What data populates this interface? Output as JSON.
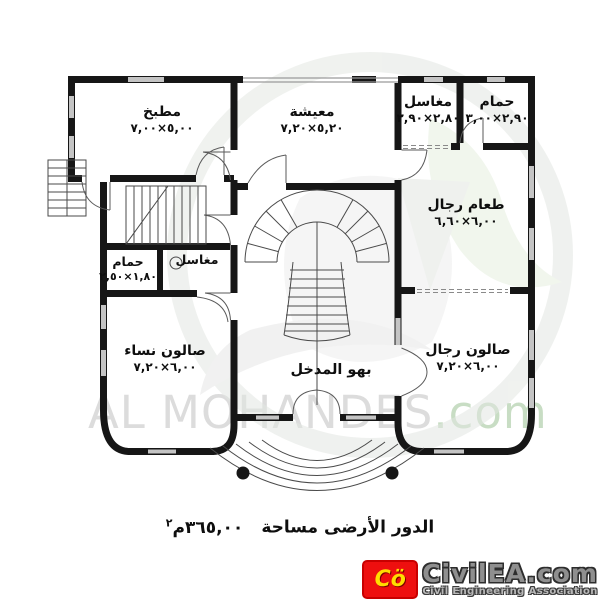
{
  "plan": {
    "rooms": [
      {
        "id": "kitchen",
        "name": "مطبخ",
        "dims": "٥,٠٠×٧,٠٠"
      },
      {
        "id": "living",
        "name": "معيشة",
        "dims": "٥,٢٠×٧,٢٠"
      },
      {
        "id": "sinks_top",
        "name": "مغاسل",
        "dims": "٢,٨٠×٢,٩٠"
      },
      {
        "id": "bath_top",
        "name": "حمام",
        "dims": "٢,٩٠×٣,٠٠"
      },
      {
        "id": "dining_men",
        "name": "طعام رجال",
        "dims": "٦,٠٠×٦,٦٠"
      },
      {
        "id": "bath_small",
        "name": "حمام",
        "dims": "١,٨٠×٢,٥٠"
      },
      {
        "id": "sinks_small",
        "name": "مغاسل",
        "dims": ""
      },
      {
        "id": "salon_women",
        "name": "صالون نساء",
        "dims": "٦,٠٠×٧,٢٠"
      },
      {
        "id": "salon_men",
        "name": "صالون رجال",
        "dims": "٦,٠٠×٧,٢٠"
      },
      {
        "id": "entry_hall",
        "name": "بهو المدخل",
        "dims": ""
      }
    ],
    "caption": {
      "label": "الدور الأرضى مساحة",
      "value": "٣٦٥,٠٠",
      "unit": "م",
      "sup": "٢"
    }
  },
  "watermark": {
    "name": "AL MOHANDES",
    "tld": ".com",
    "name_color": "#dcdcdc",
    "tld_color": "#c8ddc4"
  },
  "logo": {
    "mark": "Cö",
    "site": "CivilEA.com",
    "subtitle": "Civil Engineering Association",
    "red": "#ee0f0f",
    "yellow": "#ffdd00"
  }
}
